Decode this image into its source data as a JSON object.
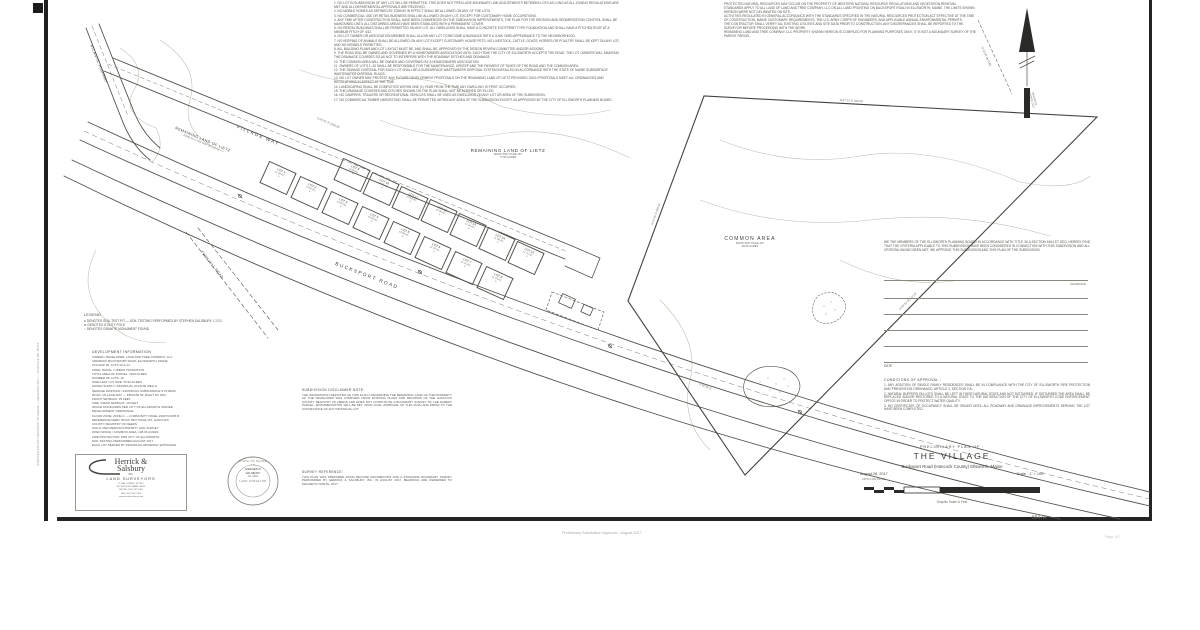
{
  "sheet": {
    "number": "5547A",
    "page_note": "Page 1/2",
    "bottom_caption": "Preliminary Subdivision Approval - August 2017",
    "side_text": "HANCOCK COUNTY REGISTRY OF DEEDS — RECEIVED 2017 — PLAN FILE NO. 5547A"
  },
  "title_block": {
    "line1": "PRELIMINARY PLAN OF :",
    "title": "THE  VILLAGE",
    "location": "Bucksport Road   (Hancock County)   Ellsworth, Maine",
    "date": "August 28, 2017",
    "scale": "Scale : 1\" = 100'",
    "scale_ticks": "100     50     0          100         200         300",
    "scale_caption": "Graphic Scale in Feet"
  },
  "roads": {
    "atlantic": "ATLANTIC HIGHWAY",
    "village_way": "VILLAGE WAY",
    "bucksport": "BUCKSPORT ROAD",
    "twin_hill": "TWIN HILL ROAD"
  },
  "parcels": {
    "remaining_center": {
      "name": "REMAINING LAND OF LIETZ",
      "book": "BOOK 5527 PAGE 167",
      "acres": "77.80 ACRES"
    },
    "remaining_rot": {
      "name": "REMAINING LAND OF LIETZ",
      "sub": "ZONE RU-2   TAX MAP 39   LOT 12"
    },
    "common": {
      "name": "COMMON  AREA",
      "book": "BOOK 5527 PAGE 167",
      "acres": "28.66 ACRES"
    }
  },
  "north": {
    "label1": "MAGNETIC",
    "label2": "NORTH  2017",
    "tie": "N 13°40' W  (TIE)"
  },
  "dims": [
    "S 62°51' E   1048.50'",
    "N 87°12' E   396.68'",
    "N 21°40' E   668.42'",
    "S 48°22' W   512.10'",
    "50' R.O.W.",
    "S 59°30' E"
  ],
  "legend": {
    "title": "LEGEND",
    "items": [
      "●  DENOTES SOIL TEST PIT — SOIL TESTING PERFORMED BY STEPHEN SALSBURY, C.S.S.",
      "⊗  DENOTES UTILITY POLE",
      "○  DENOTES GRANITE MONUMENT FOUND"
    ]
  },
  "dev_info": {
    "title": "DEVELOPMENT INFORMATION",
    "lines": [
      "OWNER / DEVELOPER:  LAND AND TREE COMPANY, LLC",
      "ADDRESS:  BUCKSPORT ROAD, ELLSWORTH, MAINE",
      "TAX MAP 39, LOTS 12 & 14",
      "ZONE:  RURAL / URBAN TRANSITION",
      "TOTAL AREA OF PARCEL:  ±106 ACRES",
      "NUMBER OF LOTS:  15",
      "SMALLEST LOT SIZE:  ±0.92 ACRES",
      "WATER SUPPLY:  INDIVIDUAL ON-SITE WELLS",
      "SEWAGE DISPOSAL:  INDIVIDUAL SUBSURFACE SYSTEMS",
      "ROAD:  VILLAGE WAY — PRIVATE 50' RIGHT OF WAY",
      "FRONT SETBACK:  25 FEET",
      "SIDE / REAR SETBACK:  15 FEET",
      "SPACE STANDARDS PER CITY OF ELLSWORTH UNIFIED",
      "DEVELOPMENT ORDINANCE",
      "FLOOD ZONE:  ZONE C — COMMUNITY PANEL 230073 0005 B",
      "REFERENCE DEED:  BOOK 5527 PAGE 167, HANCOCK",
      "COUNTY REGISTRY OF DEEDS",
      "SOILS:  PER MEDIUM INTENSITY SOIL SURVEY",
      "OPEN SPACE / COMMON AREA:  ±28.66 ACRES",
      "FIRE PROTECTION:  PER CITY OF ELLSWORTH",
      "SOIL TESTING PERFORMED AUGUST 2017",
      "EACH LOT SERVED BY INDIVIDUAL DRIVEWAY ENTRANCE"
    ]
  },
  "notes_left": {
    "items": [
      "1.  NO LOT IN SUBDIVISION OF ANY LOT WILL BE PERMITTED. THIS DOES NOT PRECLUDE BOUNDARY LINE ADJUSTMENTS BETWEEN LOTS AS LONG AS ALL ZONING REGULATIONS ARE MET AND ALL DEPARTMENTAL APPROVALS ARE RECEIVED.",
      "2.  NO MOBILE HOMES AS DEFINED BY ZONING IN EFFECT SHALL BE ALLOWED ON ANY OF THE LOTS.",
      "3.  NO COMMERCIAL USE OR RETAIL BUSINESS SHALL BE ALLOWED ON ANY LOT, EXCEPT FOR CUSTOMARY HOME OCCUPATIONS.",
      "4.  ANY TIME AFTER CONSTRUCTION SHALL HAVE BEEN COMMENCED ON THE SUBDIVISION IMPROVEMENTS, THE PLAN FOR THE EROSION AND SEDIMENTATION CONTROL SHALL BE MAINTAINED UNTIL ALL DISTURBED AREAS HAVE BEEN STABILIZED WITH A PERMANENT COVER.",
      "5.  NO RENTAL BUILDINGS SHALL BE PERMITTED ON ANY LOT. ALL DWELLINGS SHALL HAVE A CONCRETE FOOTPRINT TYPE FOUNDATION AND SHALL HAVE A PITCHED ROOF AT A MINIMUM PITCH OF 4/12.",
      "6.  NO LOT OWNER OR ASSOCIATION MEMBER SHALL ALLOW ANY LOT TO BECOME A NUISANCE WITH A JUNK YARD APPEARANCE TO THE NEIGHBORHOOD.",
      "7.  NO KEEPING OF ANIMALS SHALL BE ALLOWED ON ANY LOT EXCEPT CUSTOMARY HOUSE PETS. NO LIVESTOCK, CATTLE, GOATS, HORSES OR POULTRY SHALL BE KEPT ON ANY LOT, AND NO KENNELS PERMITTED.",
      "8.  ALL BUILDING PLANS AND LOT LAYOUT MUST BE, AND SHALL BE, APPROVED BY THE DESIGN REVIEW COMMITTEE AND/OR ASSIGNS.",
      "9.  THE ROAD WILL BE OWNED AND GOVERNED BY A HOMEOWNERS ASSOCIATION UNTIL SUCH TIME THE CITY OF ELLSWORTH ACCEPTS THE ROAD. THE LOT OWNERS WILL MAINTAIN THE DRAINAGE COURSES SO AS NOT TO INTERFERE WITH THE ROADWAY DITCHES AND DRAINAGE.",
      "10.  THE COMMON AREA WILL BE OWNED AND GOVERNED BY A HOMEOWNERS ASSOCIATION.",
      "11.  OWNERS OF LOTS 1–15 SHALL BE RESPONSIBLE FOR THE MAINTENANCE, UPKEEP AND THE PAYMENT OF TAXES OF THE ROAD AND THE COMMON AREA.",
      "12.  THE SEWAGE DISPOSAL FOR EACH LOT SHALL BE A SUBSURFACE WASTEWATER DISPOSAL SYSTEM INSTALLED IN ACCORDANCE WITH THE STATE OF MAINE SUBSURFACE WASTEWATER DISPOSAL RULES.",
      "13.  NO LOT OWNER MAY PROTEST ANY FUTURE DEVELOPMENT PROPOSALS ON THE REMAINING LAND OF LIETZ PROVIDED SUCH PROPOSALS MEET ALL ORDINANCES AND REGULATIONS IN EFFECT AT THE TIME.",
      "14.  LANDSCAPING SHALL BE COMPLETED WITHIN ONE (1) YEAR FROM THE TIME ANY DWELLING IS FIRST OCCUPIED.",
      "15.  THE DRAINAGE COURSES AND DITCHES SHOWN ON THE PLAN SHALL NOT BE ALTERED OR FILLED.",
      "16.  NO CAMPERS, TRAILERS OR RECREATIONAL VEHICLES SHALL BE USED AS DWELLINGS ON ANY LOT OR AREA OF THE SUBDIVISION.",
      "17.  NO COMMERCIAL TIMBER HARVESTING SHALL BE PERMITTED WITHIN ANY AREA OF THE SUBDIVISION EXCEPT AS APPROVED BY THE CITY OF ELLSWORTH PLANNING BOARD."
    ]
  },
  "notes_right": {
    "items": [
      "PROTECTED NATURAL RESOURCES MAY OCCUR ON THE PROPERTY OF MEISTERS NATURAL RESOURCE REGULATIONS AND VEGETATION REMOVAL STANDARDS APPLY TO ALL LAND OF LAND AND TREE COMPANY, LLC ON ALL LAND FRONTING ON BUCKSPORT ROAD IN ELLSWORTH, MAINE. THE LIMITS SHOWN HEREON WERE NOT DELINEATED ON SITE.",
      "ACTIVITIES REGULATED IN GENERAL ACCORDANCE WITH THE STANDARDS SPECIFIED IN THE NATURAL RESOURCES PROTECTION ACT EFFECTIVE AT THE TIME OF CONSTRUCTION, MAINE CUSTOMARY REQUIREMENTS, THE U.S. ARMY CORPS OF ENGINEERS, AND APPLICABLE ANNUAL ENVIRONMENTAL PERMITS.",
      "THE CONTRACTOR SHALL VERIFY ALL EXISTING UTILITIES AND SITE DATA PRIOR TO CONSTRUCTION. ANY DISCREPANCIES SHALL BE REPORTED TO THE SURVEYOR BEFORE PROCEEDING WITH THE WORK.",
      "REMAINING LAND AND TREE COMPANY, LLC PROPERTY SHOWN HEREON IS COMPILED FOR PLANNING PURPOSES ONLY; IT IS NOT A BOUNDARY SURVEY OF THE PARENT PARCEL."
    ]
  },
  "approval": {
    "statement": "WE THE MEMBERS OF THE ELLSWORTH PLANNING BOARD IN ACCORDANCE WITH TITLE 30-A SECTION 4404 ET SEQ. HEREBY FIND THAT THE CRITERIA APPLICABLE TO THIS SUBDIVISION HAVE BEEN CONSIDERED IN CONNECTION WITH THIS SUBDIVISION AND ALL CRITERIA HAVING BEEN MET, WE APPROVE THIS SUBDIVISION AND THIS PLAN OF THE SUBDIVISION.",
    "chairman_label": "CHAIRMAN",
    "date_label": "DATE",
    "conditions_title": "CONDITIONS OF APPROVAL :",
    "conditions": [
      "ANY ADDITION OF SINGLE FAMILY RESIDENCES SHALL BE IN COMPLIANCE WITH THE CITY OF ELLSWORTH FIRE PROTECTION AND PREVENTION ORDINANCE, ARTICLE 2, SECTION 2-B.",
      "NATURAL BUFFERS ON LOTS SHALL BE LEFT IN THEIR NATURAL STATE AND NOT DISTURBED. IF DISTURBED THE AREA SHALL BE REPLACED AND/OR RESTORED TO A NATURAL STATE TO THE SATISFACTION OF THE CITY OF ELLSWORTH CODE ENFORCEMENT OFFICE IN ORDER TO PROTECT WATER QUALITY.",
      "NO CERTIFICATE OF OCCUPANCY SHALL BE ISSUED UNTIL ALL ROADWAY AND DRAINAGE IMPROVEMENTS SERVING THE LOT HAVE BEEN COMPLETED."
    ]
  },
  "disclaimer": {
    "title": "SUBDIVISION DISCLAIMER NOTE:",
    "body": "THE INFORMATION DEPICTED ON THIS PLAN CONCERNING THE REMAINING LAND OF THE PROPERTY OF THE DEVELOPER WAS COMPILED FROM EXISTING PLANS AND RECORDS OF THE HANCOCK COUNTY REGISTRY OF DEEDS AND DOES NOT CONSTITUTE A BOUNDARY SURVEY OF THE PARENT PARCEL. MONUMENTATION WILL BE SET UPON FINAL APPROVAL OF THIS PLAN AND PRIOR TO THE CONVEYANCE OF ANY INDIVIDUAL LOT."
  },
  "survey_reference": {
    "title": "SURVEY REFERENCE:",
    "body": "THIS PLAN WAS PREPARED FROM RECORD INFORMATION AND A STANDARD BOUNDARY SURVEY PERFORMED BY HERRICK & SALSBURY, INC. IN AUGUST 2017. BEARINGS ARE REFERRED TO MAGNETIC NORTH, 2017."
  },
  "logo": {
    "name1": "Herrick &",
    "name2": "Salsbury",
    "inc": "INC.",
    "tagline": "LAND SURVEYORS",
    "address": [
      "12 OAK STREET, SUITE 1",
      "ELLSWORTH, MAINE 04605",
      "PHONE: (207) 667-5300",
      "FAX: (207) 667-1109",
      "www.herricksalsbury.com"
    ]
  },
  "stamp": {
    "ring_top": "STATE OF MAINE",
    "name1": "STEPHEN R.",
    "name2": "SALSBURY",
    "number": "No. 2303",
    "ring_bottom": "LAND SURVEYOR",
    "stars": "★                    ★"
  },
  "lots": [
    {
      "name": "LOT 1",
      "area": "±1.05 AC."
    },
    {
      "name": "LOT 2",
      "area": "±0.92 AC."
    },
    {
      "name": "LOT 3",
      "area": "±0.92 AC."
    },
    {
      "name": "LOT 4",
      "area": "±0.95 AC."
    },
    {
      "name": "LOT 5",
      "area": "±0.98 AC."
    },
    {
      "name": "LOT 6",
      "area": "±1.02 AC."
    },
    {
      "name": "LOT 7",
      "area": "±1.10 AC."
    },
    {
      "name": "LOT 8",
      "area": "±1.24 AC."
    },
    {
      "name": "LOT 9",
      "area": "±0.94 AC."
    },
    {
      "name": "LOT 10",
      "area": "±0.92 AC."
    },
    {
      "name": "LOT 11",
      "area": "±0.93 AC."
    },
    {
      "name": "LOT 12",
      "area": "±0.96 AC."
    },
    {
      "name": "LOT 13",
      "area": "±1.00 AC."
    },
    {
      "name": "LOT 14",
      "area": "±1.08 AC."
    },
    {
      "name": "LOT 15",
      "area": "±1.31 AC."
    }
  ],
  "colors": {
    "ink": "#4a4a46",
    "faint": "#b8b6ab",
    "border": "#222222"
  }
}
